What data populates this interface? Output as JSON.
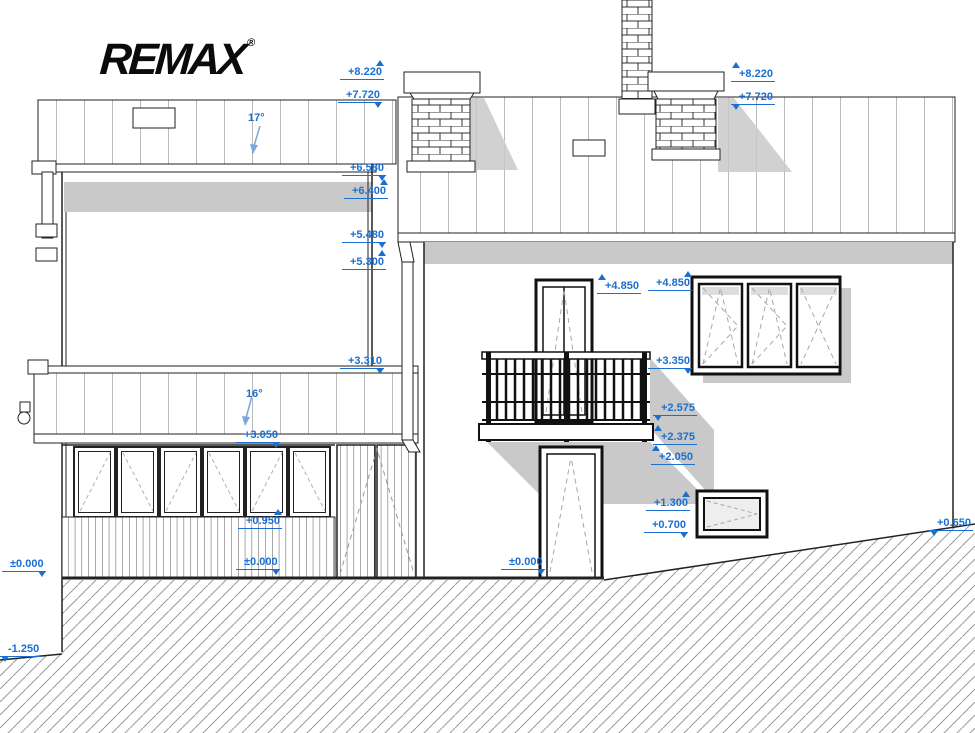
{
  "logo": {
    "text": "REMAX",
    "registered": "®"
  },
  "drawing": {
    "type": "architectural-elevation",
    "description": "House side elevation with level marks, roofs, chimneys, balcony and ground hatch",
    "roof_slopes": [
      "17°",
      "16°"
    ]
  },
  "colors": {
    "annotation_blue": "#1b6fd1",
    "shadow_gray": "#c9c9c9",
    "hatch_gray": "#9a9a9a",
    "line_black": "#222222"
  },
  "annotations": [
    {
      "text": "+8.220",
      "x": 340,
      "y": 66,
      "dir": "up",
      "side": "right"
    },
    {
      "text": "+7.720",
      "x": 338,
      "y": 89,
      "dir": "down",
      "side": "right"
    },
    {
      "text": "+6.580",
      "x": 342,
      "y": 162,
      "dir": "down",
      "side": "right"
    },
    {
      "text": "+6.400",
      "x": 344,
      "y": 185,
      "dir": "up",
      "side": "right"
    },
    {
      "text": "+5.480",
      "x": 342,
      "y": 229,
      "dir": "down",
      "side": "right"
    },
    {
      "text": "+5.300",
      "x": 342,
      "y": 256,
      "dir": "up",
      "side": "right"
    },
    {
      "text": "17°",
      "x": 248,
      "y": 112,
      "dir": "down",
      "kind": "slope"
    },
    {
      "text": "+3.310",
      "x": 340,
      "y": 355,
      "dir": "down",
      "side": "right"
    },
    {
      "text": "16°",
      "x": 246,
      "y": 388,
      "dir": "down",
      "kind": "slope"
    },
    {
      "text": "+3.050",
      "x": 236,
      "y": 429,
      "dir": "down",
      "side": "right"
    },
    {
      "text": "+0.950",
      "x": 238,
      "y": 515,
      "dir": "up",
      "side": "right"
    },
    {
      "text": "±0.000",
      "x": 236,
      "y": 556,
      "dir": "down",
      "side": "right"
    },
    {
      "text": "±0.000",
      "x": 2,
      "y": 558,
      "dir": "down",
      "side": "right"
    },
    {
      "text": "-1.250",
      "x": 0,
      "y": 643,
      "dir": "down",
      "side": "left"
    },
    {
      "text": "+4.850",
      "x": 597,
      "y": 280,
      "dir": "up",
      "side": "left"
    },
    {
      "text": "+4.850",
      "x": 648,
      "y": 277,
      "dir": "up",
      "side": "right"
    },
    {
      "text": "+3.350",
      "x": 648,
      "y": 355,
      "dir": "down",
      "side": "right"
    },
    {
      "text": "+2.575",
      "x": 653,
      "y": 402,
      "dir": "down",
      "side": "left"
    },
    {
      "text": "+2.375",
      "x": 653,
      "y": 431,
      "dir": "up",
      "side": "left"
    },
    {
      "text": "+2.050",
      "x": 651,
      "y": 451,
      "dir": "up",
      "side": "left"
    },
    {
      "text": "+1.300",
      "x": 646,
      "y": 497,
      "dir": "up",
      "side": "right"
    },
    {
      "text": "+0.700",
      "x": 644,
      "y": 519,
      "dir": "down",
      "side": "right"
    },
    {
      "text": "±0.000",
      "x": 501,
      "y": 556,
      "dir": "down",
      "side": "right"
    },
    {
      "text": "+0.650",
      "x": 929,
      "y": 517,
      "dir": "down",
      "side": "left"
    },
    {
      "text": "+8.220",
      "x": 731,
      "y": 68,
      "dir": "up",
      "side": "left"
    },
    {
      "text": "+7.720",
      "x": 731,
      "y": 91,
      "dir": "down",
      "side": "left"
    }
  ]
}
